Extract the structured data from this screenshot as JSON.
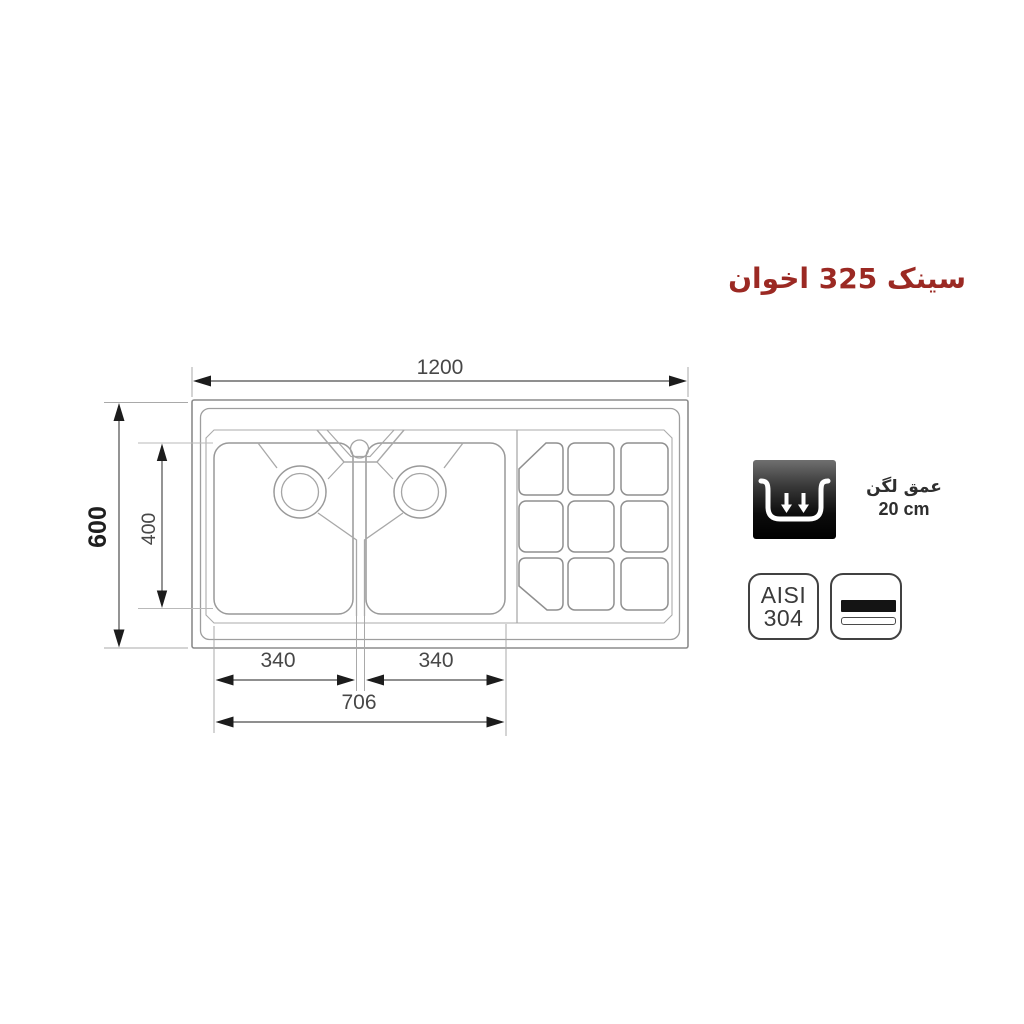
{
  "title": {
    "text": "سینک 325 اخوان",
    "color": "#9b2923"
  },
  "drawing": {
    "type": "technical-top-view-sink",
    "dimensions": {
      "overall_width": "1200",
      "overall_depth": "600",
      "bowl_zone_depth": "400",
      "left_bowl_width": "340",
      "right_bowl_width": "340",
      "bowls_span": "706"
    },
    "features": {
      "bowls": 2,
      "faucet_holes": 1,
      "drainboard_grid": "3x3"
    }
  },
  "specs": {
    "bowl_depth": {
      "label": "عمق لگن",
      "value": "20 cm"
    },
    "steel_grade": {
      "line1": "AISI",
      "line2": "304"
    }
  },
  "colors": {
    "accent_red": "#9b2923",
    "dim_line": "#4c4c4c",
    "sink_line": "#9a9a9a"
  }
}
